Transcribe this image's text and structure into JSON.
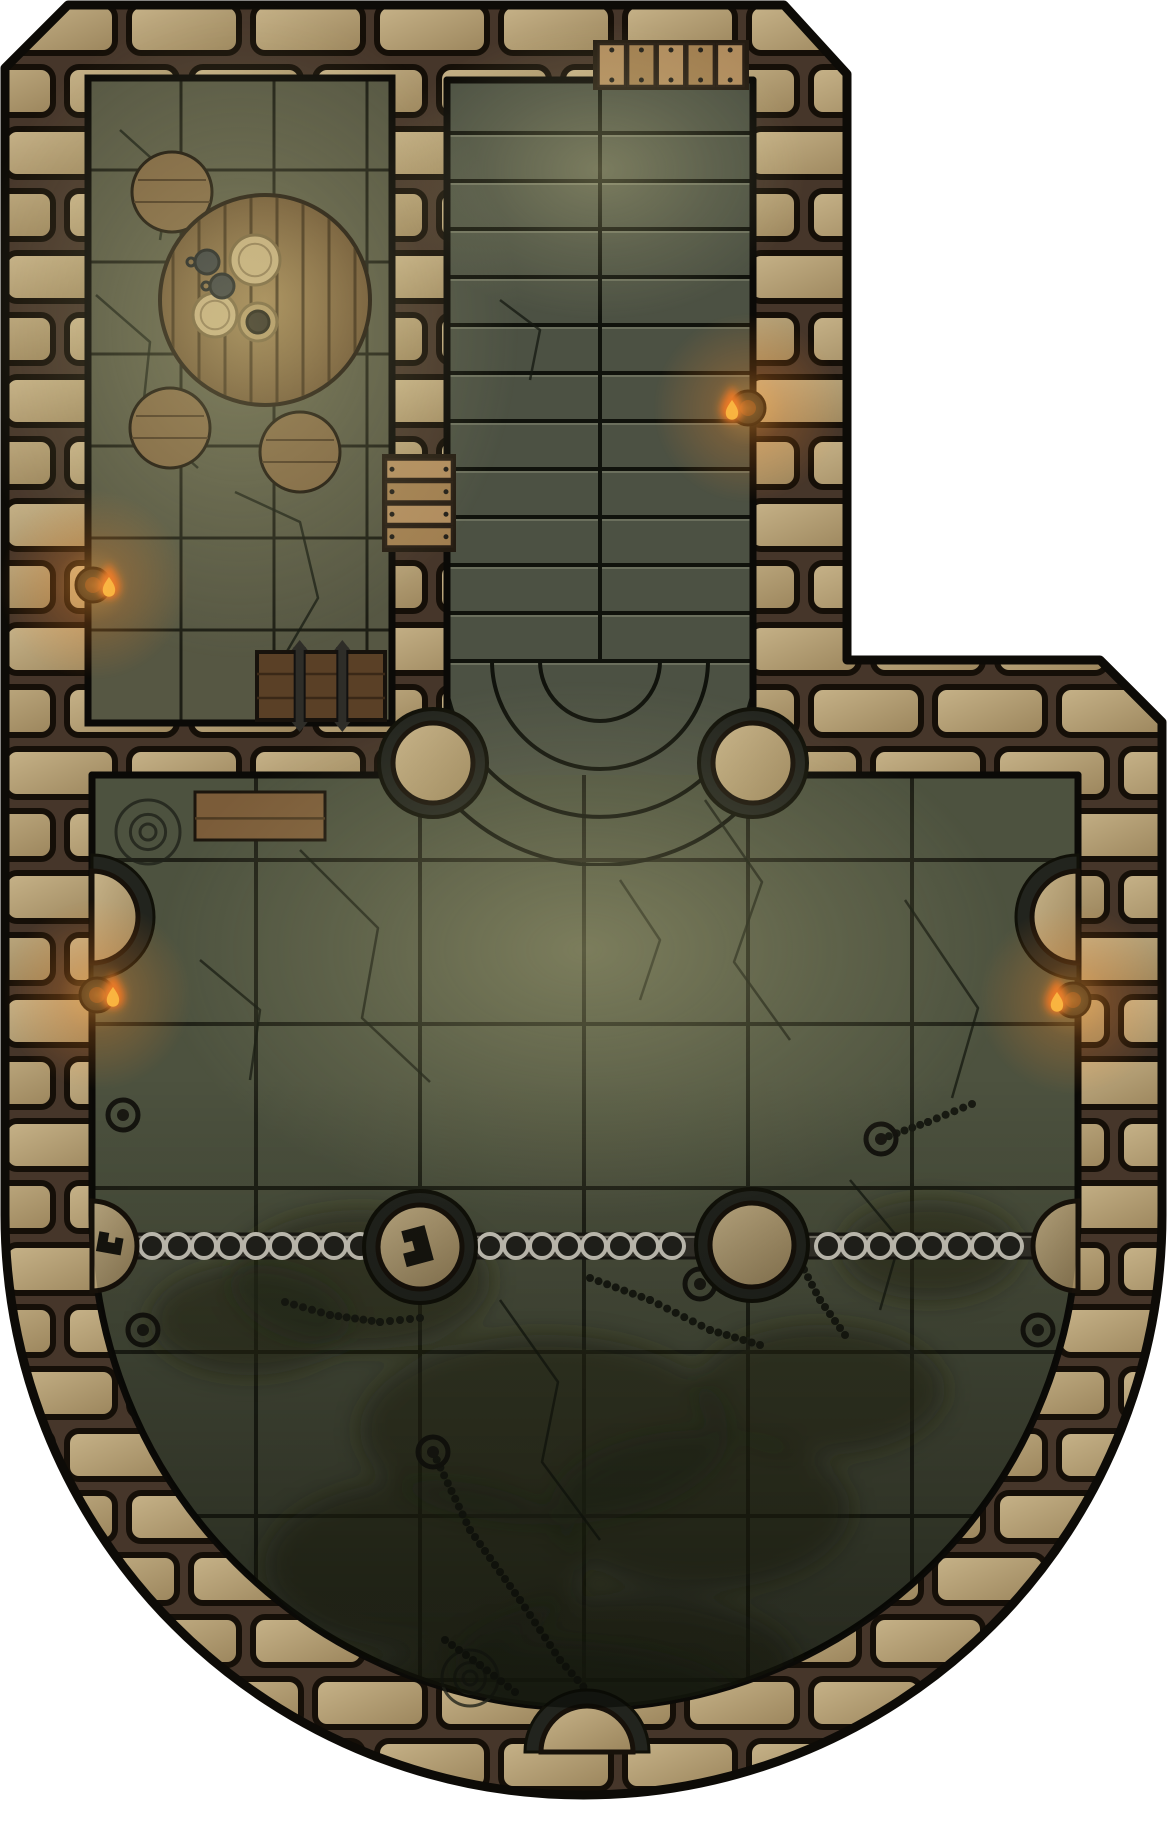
{
  "canvas": {
    "width": 1167,
    "height": 1830,
    "viewBox": "0 0 1167 1830",
    "background": "#ffffff"
  },
  "palette": {
    "outline": "#0d0b07",
    "mortar": "#46362a",
    "stone_light": "#c7b389",
    "stone_dark": "#9b855c",
    "block_joint": "#150f08",
    "floor_room": "#565743",
    "floor_stairs": "#4c5143",
    "floor_hall": "#4d523f",
    "floor_hall_deep": "#343a2a",
    "tile_line": "#14150e",
    "wood_table": "#8a6d44",
    "wood_plank_gap": "#3f2d18",
    "wood_chest": "#5a4026",
    "wood_bench": "#7b5c39",
    "wood_door": "#b08c5e",
    "metal_dark": "#23221d",
    "metal_ring": "#d6d2c6",
    "pillar_dark": "#22241e",
    "flame_outer": "#e2661a",
    "flame_inner": "#f6c044",
    "moss": "#242b19",
    "crack": "#141810"
  },
  "outer_wall": {
    "points": [
      [
        68,
        5
      ],
      [
        784,
        5
      ],
      [
        847,
        74
      ],
      [
        847,
        660
      ],
      [
        1100,
        660
      ],
      [
        1162,
        722
      ],
      [
        1162,
        1215
      ]
    ],
    "arc_r": 578.5,
    "arc_end": [
      5,
      1215
    ],
    "close_to": [
      5,
      68
    ],
    "stroke_width": 9
  },
  "regions": {
    "guard_room": {
      "x": 88,
      "y": 78,
      "w": 304,
      "h": 645,
      "tile": 93
    },
    "staircase": {
      "x": 447,
      "y": 80,
      "w": 306,
      "h": 780,
      "step_top": 85,
      "step_h": 48,
      "steps": 12,
      "divider_x": 600,
      "fan": {
        "cx": 600,
        "cy": 661,
        "radii": [
          60,
          108,
          156,
          204
        ]
      }
    },
    "main_hall": {
      "x1": 92,
      "x2": 1078,
      "y_top": 775,
      "y_straight": 1215,
      "cx": 585,
      "r": 493,
      "grid_verticals": [
        256,
        420,
        584,
        748,
        912
      ],
      "grid_horizontals": [
        860,
        1024,
        1188,
        1352,
        1516,
        1680
      ]
    }
  },
  "props": {
    "round_table": {
      "cx": 265,
      "cy": 300,
      "r": 105,
      "plank_gap": 26
    },
    "stools": {
      "r": 40,
      "positions": [
        [
          172,
          192
        ],
        [
          170,
          428
        ],
        [
          300,
          452
        ]
      ]
    },
    "tableware": {
      "plates": [
        [
          255,
          260,
          25
        ],
        [
          215,
          315,
          22
        ]
      ],
      "mugs": {
        "r": 12,
        "positions": [
          [
            207,
            262
          ],
          [
            222,
            286
          ]
        ]
      },
      "cup": {
        "x": 258,
        "y": 322,
        "saucer_r": 19,
        "cup_r": 11
      }
    },
    "chest": {
      "x": 257,
      "y": 652,
      "w": 128,
      "h": 68,
      "straps": 2
    },
    "bench": {
      "x": 195,
      "y": 792,
      "w": 130,
      "h": 48
    },
    "doors": [
      {
        "name": "stair-top-door",
        "x": 597,
        "y": 44,
        "w": 148,
        "h": 42,
        "planks": 5,
        "dir": "v"
      },
      {
        "name": "guard-room-door",
        "x": 386,
        "y": 458,
        "w": 66,
        "h": 90,
        "planks": 4,
        "dir": "h"
      }
    ],
    "junction_pillars": {
      "ring_r": 54,
      "cap_r": 40,
      "positions": [
        [
          433,
          763
        ],
        [
          753,
          763
        ]
      ]
    },
    "rail_pillars": {
      "ring_r": 56,
      "cap_r": 42,
      "positions": [
        [
          420,
          1247
        ],
        [
          752,
          1245
        ]
      ],
      "glyph_on": 0
    },
    "chain_rail": {
      "y": 1246,
      "x1": 92,
      "x2": 1078,
      "bar_h": 24,
      "ring_r": 12,
      "ring_spacing": 26,
      "ring_start": 152,
      "ring_end": 1020,
      "pillar_gap": 58
    },
    "rail_stubs": {
      "cap_r": 45,
      "positions": [
        [
          92,
          1246,
          "e"
        ],
        [
          1078,
          1246,
          "w"
        ]
      ],
      "glyph_on": 0
    },
    "wall_nubs": {
      "dark_r": 62,
      "cap_r": 46,
      "positions": [
        [
          92,
          917,
          "e"
        ],
        [
          1078,
          917,
          "w"
        ],
        [
          587,
          1752,
          "n"
        ]
      ]
    },
    "torches": [
      [
        93,
        585,
        "w"
      ],
      [
        748,
        408,
        "e"
      ],
      [
        97,
        995,
        "w"
      ],
      [
        1073,
        1000,
        "e"
      ]
    ],
    "floor_rings": [
      [
        123,
        1115
      ],
      [
        143,
        1330
      ],
      [
        881,
        1139
      ],
      [
        1038,
        1330
      ],
      [
        433,
        1452
      ],
      [
        700,
        1284
      ]
    ],
    "chains": [
      [
        [
          433,
          1452
        ],
        [
          470,
          1530
        ],
        [
          520,
          1600
        ],
        [
          560,
          1660
        ],
        [
          595,
          1700
        ]
      ],
      [
        [
          285,
          1302
        ],
        [
          330,
          1315
        ],
        [
          380,
          1322
        ],
        [
          420,
          1318
        ]
      ],
      [
        [
          590,
          1278
        ],
        [
          650,
          1300
        ],
        [
          710,
          1330
        ],
        [
          760,
          1345
        ]
      ],
      [
        [
          800,
          1262
        ],
        [
          820,
          1300
        ],
        [
          845,
          1335
        ]
      ],
      [
        [
          445,
          1640
        ],
        [
          480,
          1665
        ],
        [
          515,
          1692
        ]
      ],
      [
        [
          881,
          1139
        ],
        [
          928,
          1122
        ],
        [
          972,
          1104
        ]
      ]
    ],
    "engravings": [
      [
        148,
        832,
        32
      ],
      [
        470,
        1678,
        28
      ]
    ],
    "moss_patches": [
      [
        360,
        1280,
        130,
        70
      ],
      [
        545,
        1430,
        185,
        95
      ],
      [
        700,
        1510,
        150,
        80
      ],
      [
        425,
        1565,
        160,
        85
      ],
      [
        625,
        1665,
        170,
        70
      ],
      [
        250,
        1320,
        100,
        55
      ],
      [
        820,
        1390,
        125,
        65
      ],
      [
        540,
        1700,
        200,
        60
      ],
      [
        930,
        1250,
        90,
        50
      ]
    ],
    "cracks": [
      [
        [
          96,
          295
        ],
        [
          150,
          342
        ],
        [
          142,
          418
        ],
        [
          198,
          468
        ]
      ],
      [
        [
          235,
          492
        ],
        [
          300,
          522
        ],
        [
          318,
          598
        ],
        [
          282,
          660
        ]
      ],
      [
        [
          120,
          130
        ],
        [
          170,
          175
        ],
        [
          160,
          240
        ]
      ],
      [
        [
          300,
          850
        ],
        [
          378,
          928
        ],
        [
          362,
          1018
        ],
        [
          430,
          1082
        ]
      ],
      [
        [
          705,
          800
        ],
        [
          762,
          882
        ],
        [
          734,
          962
        ],
        [
          790,
          1040
        ]
      ],
      [
        [
          905,
          900
        ],
        [
          978,
          1008
        ],
        [
          952,
          1098
        ]
      ],
      [
        [
          500,
          1300
        ],
        [
          558,
          1382
        ],
        [
          542,
          1462
        ],
        [
          600,
          1540
        ]
      ],
      [
        [
          200,
          960
        ],
        [
          260,
          1010
        ],
        [
          250,
          1080
        ]
      ],
      [
        [
          850,
          1180
        ],
        [
          900,
          1240
        ],
        [
          880,
          1310
        ]
      ],
      [
        [
          620,
          880
        ],
        [
          660,
          940
        ],
        [
          640,
          1000
        ]
      ],
      [
        [
          500,
          300
        ],
        [
          540,
          330
        ],
        [
          530,
          380
        ]
      ]
    ],
    "lights": {
      "room_pool": {
        "cx": 240,
        "cy": 330,
        "rx": 280,
        "ry": 330
      },
      "stair_pool": {
        "cx": 600,
        "cy": 170,
        "rx": 210,
        "ry": 150
      },
      "hall_pool": {
        "cx": 585,
        "cy": 950,
        "rx": 430,
        "ry": 270
      },
      "depth_shade": {
        "y_from": 1080,
        "y_to": 1740
      }
    }
  }
}
